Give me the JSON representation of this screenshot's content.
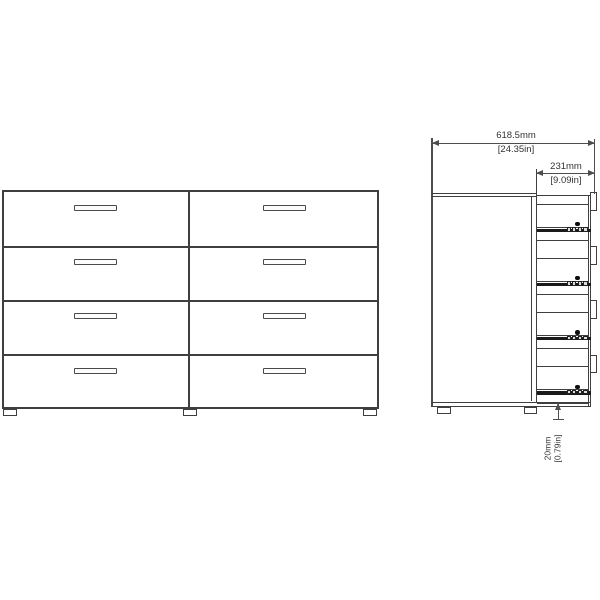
{
  "drawing": {
    "views": {
      "front": {
        "drawer_rows": 4,
        "drawer_columns": 2,
        "drawer_count": 8,
        "handles_per_drawer": 1,
        "feet_count": 3
      },
      "side": {
        "drawer_slide_count": 4,
        "feet_count": 2
      }
    },
    "dimensions": [
      {
        "name": "overall-depth",
        "mm": "618.5mm",
        "inches": "[24.35in]",
        "orientation": "horizontal"
      },
      {
        "name": "drawer-depth",
        "mm": "231mm",
        "inches": "[9.09in]",
        "orientation": "horizontal"
      },
      {
        "name": "foot-height",
        "mm": "20mm",
        "inches": "[0.79in]",
        "orientation": "vertical"
      }
    ],
    "colors": {
      "background": "#ffffff",
      "line": "#3f3f3f",
      "thin_line": "#4a4a4a",
      "dim_line": "#4d4d4d",
      "rail": "#1a1a1a",
      "hardware_dot": "#0d0d0d",
      "text": "#333333"
    }
  }
}
